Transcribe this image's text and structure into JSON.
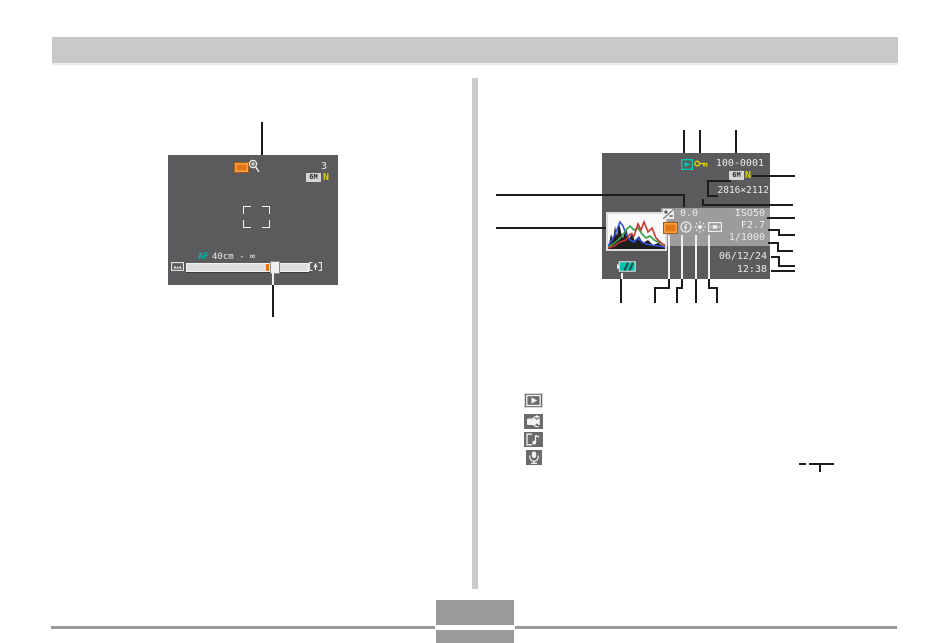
{
  "page": {
    "description": "Camera manual page showing two monitor-screen diagrams with callout lines"
  },
  "left_screen": {
    "name": "REC mode monitor screen",
    "remaining_capacity": "3",
    "image_quality": "6M",
    "quality_mode": "N",
    "af_label": "AF",
    "focus_range": "40cm - ∞"
  },
  "right_screen": {
    "name": "PLAY mode monitor screen",
    "file_number": "100-0001",
    "image_quality": "6M",
    "quality_mode": "N",
    "resolution": "2816×2112",
    "ev_value": "0.0",
    "iso": "ISO50",
    "aperture": "F2.7",
    "shutter_speed": "1/1000",
    "date": "06/12/24",
    "time": "12:38"
  },
  "icons": {
    "left_screen": [
      "snapshot-mode-icon",
      "digital-zoom-icon",
      "zoom-wide-icon",
      "zoom-tele-icon",
      "focus-frame"
    ],
    "right_screen": [
      "playback-mode-icon",
      "protect-key-icon",
      "histogram-thumbnail",
      "ev-compensation-icon",
      "snapshot-icon",
      "flash-mode-icon",
      "white-balance-icon",
      "metering-mode-icon",
      "battery-level-icon"
    ],
    "mode_column": [
      "snapshot-playback-icon",
      "movie-playback-icon",
      "audio-snapshot-icon",
      "voice-record-icon"
    ]
  },
  "colors": {
    "screen_bg": "#5b5b5d",
    "info_band": "#9c9c9c",
    "teal": "#00c6b4",
    "yellow": "#d8d200",
    "orange": "#e07818",
    "bar_gray": "#c9c9c9",
    "rule_gray": "#9a9a9a",
    "lcd_text": "#eaeaea"
  }
}
